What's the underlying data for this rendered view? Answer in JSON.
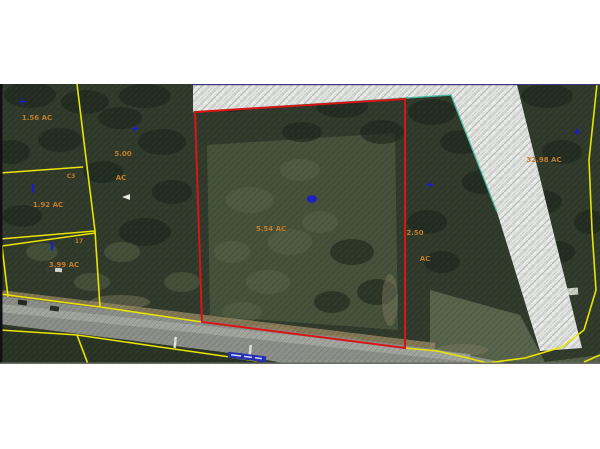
{
  "map": {
    "type": "aerial-parcel-map",
    "colors": {
      "forest_base": "#313b2c",
      "forest_dark": "#18221a",
      "forest_light": "#5a6549",
      "field_green": "#47523b",
      "road_gray": "#8e918b",
      "road_stripe": "#b7bab3",
      "road_shoulder": "#a08e66",
      "cleared_strip": "#e7e8e4",
      "strip_streak": "#c3c9d2",
      "teal_edge": "#48c4ae",
      "boundary_yellow": "#e8e400",
      "highlight_red": "#d81414",
      "top_border_navy": "#3a3a74",
      "label_orange": "#c07c28",
      "marker_blue": "#1c1cd0",
      "road_label_blue": "#2330b4",
      "frame_black": "#111111"
    },
    "selected_parcel": {
      "acreage_label": "5.54 AC"
    },
    "parcel_labels": [
      {
        "name": "parcel-acreage-1-56",
        "text": "1.56 AC",
        "x": 37,
        "y": 120,
        "size": 7
      },
      {
        "name": "parcel-acreage-5-00",
        "text": "5.00",
        "x": 123,
        "y": 156,
        "size": 7
      },
      {
        "name": "parcel-acreage-5-00-unit",
        "text": "AC",
        "x": 121,
        "y": 180,
        "size": 7
      },
      {
        "name": "lot-code-c3",
        "text": "C3",
        "x": 71,
        "y": 178,
        "size": 6
      },
      {
        "name": "parcel-acreage-1-92",
        "text": "1.92 AC",
        "x": 48,
        "y": 207,
        "size": 7
      },
      {
        "name": "lot-code-17",
        "text": "17",
        "x": 79,
        "y": 243,
        "size": 6
      },
      {
        "name": "parcel-acreage-3-99",
        "text": "3.99 AC",
        "x": 64,
        "y": 267,
        "size": 7
      },
      {
        "name": "parcel-acreage-5-54",
        "text": "5.54 AC",
        "x": 271,
        "y": 231,
        "size": 7
      },
      {
        "name": "parcel-acreage-2-50",
        "text": "2.50",
        "x": 415,
        "y": 235,
        "size": 7
      },
      {
        "name": "parcel-acreage-2-50-unit",
        "text": "AC",
        "x": 425,
        "y": 261,
        "size": 7
      },
      {
        "name": "parcel-acreage-32-98",
        "text": "32.98 AC",
        "x": 544,
        "y": 162,
        "size": 7
      }
    ],
    "markers": [
      {
        "name": "parcel-point-marker",
        "type": "cross",
        "x": 22,
        "y": 101
      },
      {
        "name": "parcel-point-marker",
        "type": "cross",
        "x": 135,
        "y": 128
      },
      {
        "name": "parcel-point-marker",
        "type": "dash",
        "x": 33,
        "y": 188
      },
      {
        "name": "parcel-point-marker",
        "type": "dash",
        "x": 52,
        "y": 246
      },
      {
        "name": "parcel-point-marker",
        "type": "blob",
        "x": 312,
        "y": 199
      },
      {
        "name": "parcel-point-marker",
        "type": "cross",
        "x": 430,
        "y": 184
      },
      {
        "name": "parcel-point-marker",
        "type": "cross",
        "x": 577,
        "y": 131
      }
    ],
    "road_label": {
      "x": 247,
      "y": 357,
      "width": 38,
      "height": 6,
      "rotation": 7
    }
  }
}
